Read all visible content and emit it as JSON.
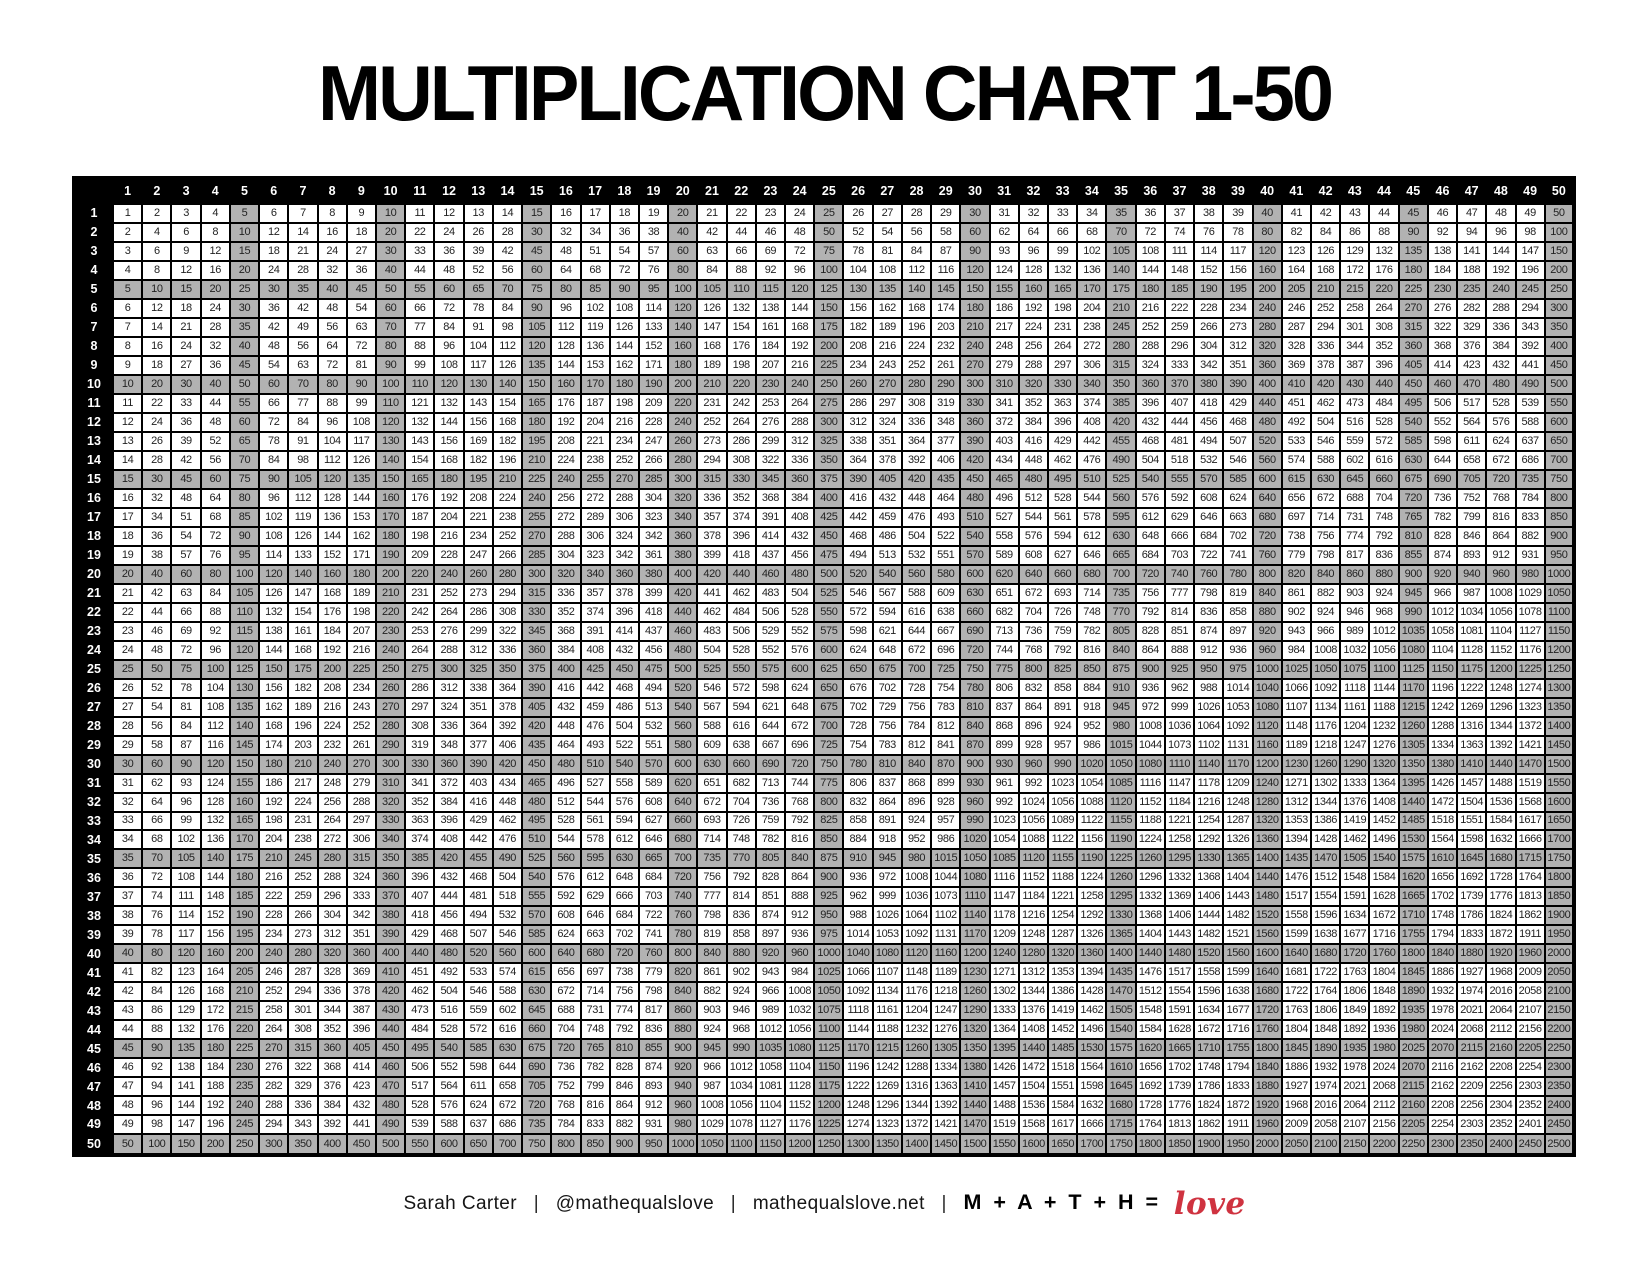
{
  "page": {
    "title": "MULTIPLICATION CHART 1-50",
    "background_color": "#ffffff"
  },
  "table": {
    "description": "Multiplication grid; each cell is the product of its row header and column header",
    "operation": "multiply",
    "shade_multiple": 5,
    "shading_rule": "every row and column that is a multiple of 5 is shaded gray",
    "col_headers": [
      1,
      2,
      3,
      4,
      5,
      6,
      7,
      8,
      9,
      10,
      11,
      12,
      13,
      14,
      15,
      16,
      17,
      18,
      19,
      20,
      21,
      22,
      23,
      24,
      25,
      26,
      27,
      28,
      29,
      30,
      31,
      32,
      33,
      34,
      35,
      36,
      37,
      38,
      39,
      40,
      41,
      42,
      43,
      44,
      45,
      46,
      47,
      48,
      49,
      50
    ],
    "row_headers": [
      1,
      2,
      3,
      4,
      5,
      6,
      7,
      8,
      9,
      10,
      11,
      12,
      13,
      14,
      15,
      16,
      17,
      18,
      19,
      20,
      21,
      22,
      23,
      24,
      25,
      26,
      27,
      28,
      29,
      30,
      31,
      32,
      33,
      34,
      35,
      36,
      37,
      38,
      39,
      40,
      41,
      42,
      43,
      44,
      45,
      46,
      47,
      48,
      49,
      50
    ],
    "corner_label": "",
    "min_product": 1,
    "max_product": 2500,
    "colors": {
      "header_background": "#000000",
      "header_text": "#ffffff",
      "cell_background": "#ffffff",
      "shaded_cell_background": "#b2b2b2",
      "grid_border": "#000000",
      "cell_text": "#222222"
    }
  },
  "footer": {
    "author": "Sarah Carter",
    "separator": "|",
    "handle": "@mathequalslove",
    "website": "mathequalslove.net",
    "math_text": "M + A + T + H =",
    "love_text": "love",
    "love_color": "#cf3340"
  }
}
